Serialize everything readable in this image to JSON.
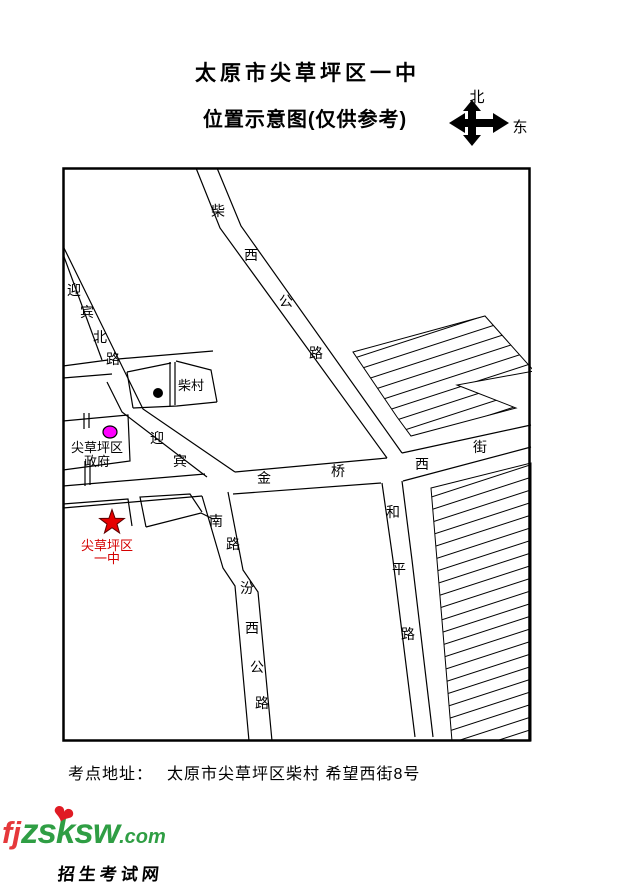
{
  "header": {
    "title": "太原市尖草坪区一中",
    "subtitle": "位置示意图(仅供参考)"
  },
  "compass": {
    "north_label": "北",
    "east_label": "东"
  },
  "map": {
    "street_chars": [
      {
        "t": "柴",
        "x": 218,
        "y": 216
      },
      {
        "t": "西",
        "x": 251,
        "y": 260
      },
      {
        "t": "公",
        "x": 286,
        "y": 306
      },
      {
        "t": "路",
        "x": 316,
        "y": 358
      },
      {
        "t": "迎",
        "x": 74,
        "y": 295
      },
      {
        "t": "宾",
        "x": 87,
        "y": 317
      },
      {
        "t": "北",
        "x": 100,
        "y": 342
      },
      {
        "t": "路",
        "x": 113,
        "y": 364
      },
      {
        "t": "迎",
        "x": 157,
        "y": 443
      },
      {
        "t": "宾",
        "x": 180,
        "y": 466
      },
      {
        "t": "金",
        "x": 264,
        "y": 483
      },
      {
        "t": "桥",
        "x": 338,
        "y": 476
      },
      {
        "t": "西",
        "x": 422,
        "y": 469
      },
      {
        "t": "街",
        "x": 480,
        "y": 452
      },
      {
        "t": "南",
        "x": 216,
        "y": 526
      },
      {
        "t": "路",
        "x": 233,
        "y": 549
      },
      {
        "t": "汾",
        "x": 247,
        "y": 593
      },
      {
        "t": "西",
        "x": 252,
        "y": 633
      },
      {
        "t": "公",
        "x": 257,
        "y": 672
      },
      {
        "t": "路",
        "x": 262,
        "y": 708
      },
      {
        "t": "和",
        "x": 393,
        "y": 517
      },
      {
        "t": "平",
        "x": 399,
        "y": 574
      },
      {
        "t": "路",
        "x": 408,
        "y": 639
      }
    ],
    "markers": {
      "school": {
        "line1": "尖草坪区",
        "line2": "一中",
        "symbol": "red-star"
      },
      "government": {
        "line1": "尖草坪区",
        "line2": "政府",
        "symbol": "magenta-dot"
      },
      "village": {
        "label": "柴村",
        "symbol": "black-dot"
      }
    }
  },
  "footer": {
    "address_label": "考点地址：",
    "address": "太原市尖草坪区柴村 希望西街8号"
  },
  "watermark": {
    "site_prefix": "fj",
    "site_mid": "zsksw",
    "site_suffix": ".com",
    "heart": "❤",
    "caption": "招生考试网"
  },
  "colors": {
    "school_red": "#d40000",
    "government_magenta": "#ff00ff",
    "village_black": "#000000",
    "logo_red": "#e5383b",
    "logo_green": "#2f9e44",
    "ink": "#000000"
  }
}
